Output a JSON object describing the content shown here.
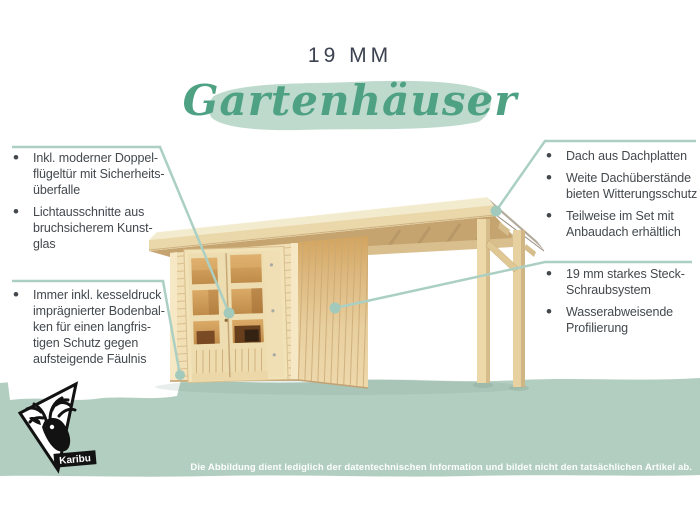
{
  "ui": {
    "bullet": "•"
  },
  "title": {
    "size_label": "19 MM",
    "category_label": "Gartenhäuser"
  },
  "features": {
    "left_top": [
      "Inkl. moderner Doppel-\nflügeltür mit Sicherheits-\nüberfalle",
      "Lichtausschnitte aus\nbruchsicherem Kunst-\nglas"
    ],
    "left_bottom": [
      "Immer inkl. kesseldruck\nimprägnierter Bodenbal-\nken für einen langfris-\ntigen Schutz gegen\naufsteigende Fäulnis"
    ],
    "right_top": [
      "Dach aus Dachplatten",
      "Weite Dachüberstände\nbieten Witterungsschutz",
      "Teilweise im Set mit\nAnbaudach erhältlich"
    ],
    "right_bottom": [
      "19 mm starkes Steck-\nSchraubsystem",
      "Wasserabweisende\nProfilierung"
    ]
  },
  "footer": {
    "disclaimer": "Die Abbildung dient lediglich der datentechnischen Information und bildet nicht den tatsächlichen Artikel ab."
  },
  "logo": {
    "label": "Karibu"
  },
  "colors": {
    "accent_green": "#4ea183",
    "brush_green": "#bedacd",
    "band_green": "#b2cec0",
    "connector_teal": "#abd0c3",
    "dot_teal": "#a2cabc",
    "wood_light": "#f1ddb2",
    "text_dark": "#43484d",
    "title_dark": "#3b4150"
  }
}
